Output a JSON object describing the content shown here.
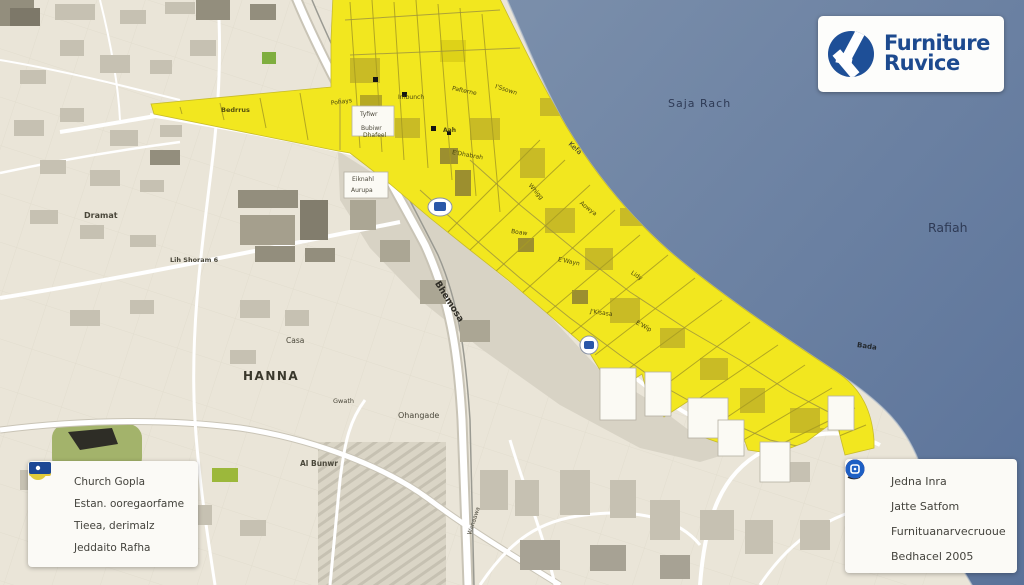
{
  "logo": {
    "line1": "Furniture",
    "line2": "Ruvice",
    "icon": "abstract-triangle-logo",
    "text_color": "#1d4a8f",
    "mark_color": "#1e4f97"
  },
  "map": {
    "colors": {
      "water": "#68809f",
      "land": "#eae5d8",
      "highlight_zone": "#f2e71f",
      "zone_patch_dark": "#c9bb25",
      "road": "#ffffff",
      "building": "#c6c1b2",
      "park_green": "#a3b36b"
    },
    "labels": [
      {
        "text": "Saja Rach"
      },
      {
        "text": "Rafiah"
      },
      {
        "text": "HANNA"
      },
      {
        "text": "Dramat"
      },
      {
        "text": "Lih Shoram 6"
      },
      {
        "text": "Casa"
      },
      {
        "text": "Ohangade"
      },
      {
        "text": "Gwath"
      },
      {
        "text": "Al Bunwr"
      },
      {
        "text": "Bhemosa"
      },
      {
        "text": "Kefa"
      },
      {
        "text": "Bada"
      },
      {
        "text": "Bedrrus"
      },
      {
        "text": "Tyfiwr"
      },
      {
        "text": "Bubiwr"
      },
      {
        "text": "Eiknahl"
      },
      {
        "text": "Aurupa"
      },
      {
        "text": "Pohays"
      },
      {
        "text": "Imbunch"
      },
      {
        "text": "Pafterne"
      },
      {
        "text": "I'Ssown"
      },
      {
        "text": "Dhafeel"
      },
      {
        "text": "Aah"
      },
      {
        "text": "E'Dhabrah"
      },
      {
        "text": "Whigg"
      },
      {
        "text": "Aowya"
      },
      {
        "text": "Boaw"
      },
      {
        "text": "E'Wayn"
      },
      {
        "text": "Lidy"
      },
      {
        "text": "J'Kisasa"
      },
      {
        "text": "E'Wip"
      },
      {
        "text": "Wanaawa"
      }
    ]
  },
  "legend_left": {
    "items": [
      {
        "icon": "briefcase-icon",
        "color": "#e5c63a",
        "label": "Church Gopla"
      },
      {
        "icon": "circle-area-icon",
        "color": "#e0ca3c",
        "label": "Estan. ooregaorfame"
      },
      {
        "icon": "green-area-icon",
        "color": "#9cb83b",
        "label": "Tieea, derimalz"
      },
      {
        "icon": "blue-marker-icon",
        "color": "#1c4795",
        "label": "Jeddaito Rafha"
      }
    ]
  },
  "legend_right": {
    "items": [
      {
        "icon": "location-pin-icon",
        "color": "#23272e",
        "label": "Jedna Inra"
      },
      {
        "icon": "green-badge-icon",
        "color": "#5fbf36",
        "label": "Jatte Satfom"
      },
      {
        "icon": "purple-badge-icon",
        "color": "#9c1d8e",
        "label": "Furnituanarvecruoue"
      },
      {
        "icon": "blue-badge-icon",
        "color": "#1d5fc4",
        "label": "Bedhacel 2005"
      }
    ]
  }
}
